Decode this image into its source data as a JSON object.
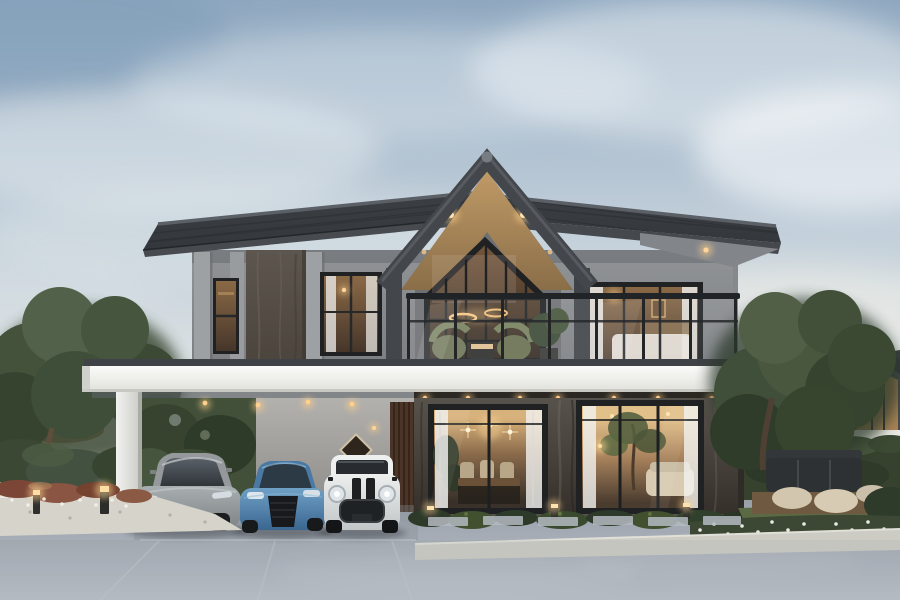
{
  "scene": {
    "description": "Photorealistic dusk rendering of a modern two-storey charcoal-grey villa with a tall A-frame central gable, wood-lined soffit with recessed downlights, a glass-railed balcony with rattan chairs, floor-to-ceiling warm-lit windows, and a white flat-roof carport sheltering three cars: a silver sedan, a blue coupe and a white Mini-style SUV with black bonnet stripes. Landscaped garden with trees, hedges, white flowers, bollard lights, a neighbouring gabled house to the right and a wide grey driveway in the foreground.",
    "time_of_day": "dusk",
    "style": "contemporary luxury house exterior rendering"
  },
  "objects": {
    "main_house": "two-storey modern villa, grey walls with dark stone accent panels",
    "central_gable": "A-frame gable with grey trim, tan wood soffit, recessed warm downlights and a gable-shaped gridded window with ring pendant lights inside",
    "balcony": "glass railing balcony with two olive rattan chairs, lit side table and potted plant",
    "second_floor_windows": "narrow window, curtained bedroom window with warm interior",
    "facade_band": "white fascia band between floors with recessed warm downlights underneath",
    "carport": "flat white canopy carport with white column, diamond wall decor and wood-slat door",
    "cars": [
      "silver electric sedan",
      "blue coupe with large dark grille",
      "white compact SUV with twin black bonnet stripes"
    ],
    "ground_floor_windows": "dining room glazing with starburst chandelier and table; living room glazing with indoor tree and beige sofa",
    "garden": "trees, clipped hedges, red shrubs, white flower beds, gravel border, glowing bollard lights",
    "neighbor_house": "white gabled house with dark roof and warm windows behind hedge",
    "right_yard": "outdoor lounge with dark sofa and beige poufs on wooden deck, lawn",
    "driveway": "wide light-grey concrete driveway with pale curb"
  },
  "palette": {
    "sky_top": "#8fa8c0",
    "sky_mid": "#c2cfda",
    "sky_low": "#dfe4e4",
    "sky_horizon": "#ece9e1",
    "cloud_white": "#f4f6f7",
    "roof_dark": "#34383c",
    "roof_ridge": "#5b6066",
    "roof_fascia": "#474b50",
    "gable_frame": "#43474c",
    "wood_soffit": "#c09a67",
    "wood_soffit_dark": "#8a6e48",
    "wall_light": "#919497",
    "wall_dark": "#7b7e82",
    "pilaster": "#9ea1a4",
    "stone_upper": "#5d564e",
    "stone_lower": "#4b443c",
    "window_frame": "#1f2123",
    "warm_glow": "#ffcf8a",
    "interior_warm": "#b98c54",
    "interior_dark": "#352d26",
    "band_white": "#f7f7f4",
    "column_white": "#f2f2f0",
    "carport_wall": "#b3b1ad",
    "door_slats": "#4a3528",
    "stone_wall_top": "#57524c",
    "stone_wall_bottom": "#332e29",
    "curtain_white": "#f2f2f0",
    "green_dark": "#35412f",
    "green_mid": "#47563b",
    "green_light": "#5a6b45",
    "lawn": "#5a6a44",
    "gravel": "#d6d3cb",
    "flower_red": "#7c4637",
    "drive_top": "#99a0aa",
    "drive_bottom": "#bbc1c9",
    "curb": "#ccccc5",
    "car_silver": "#a9aeb1",
    "car_blue": "#4e80ad",
    "car_white": "#edefee",
    "pouf_beige": "#d2c6ae",
    "deck_wood": "#6f5a41",
    "neighbor_wall": "#e7e4dd"
  }
}
